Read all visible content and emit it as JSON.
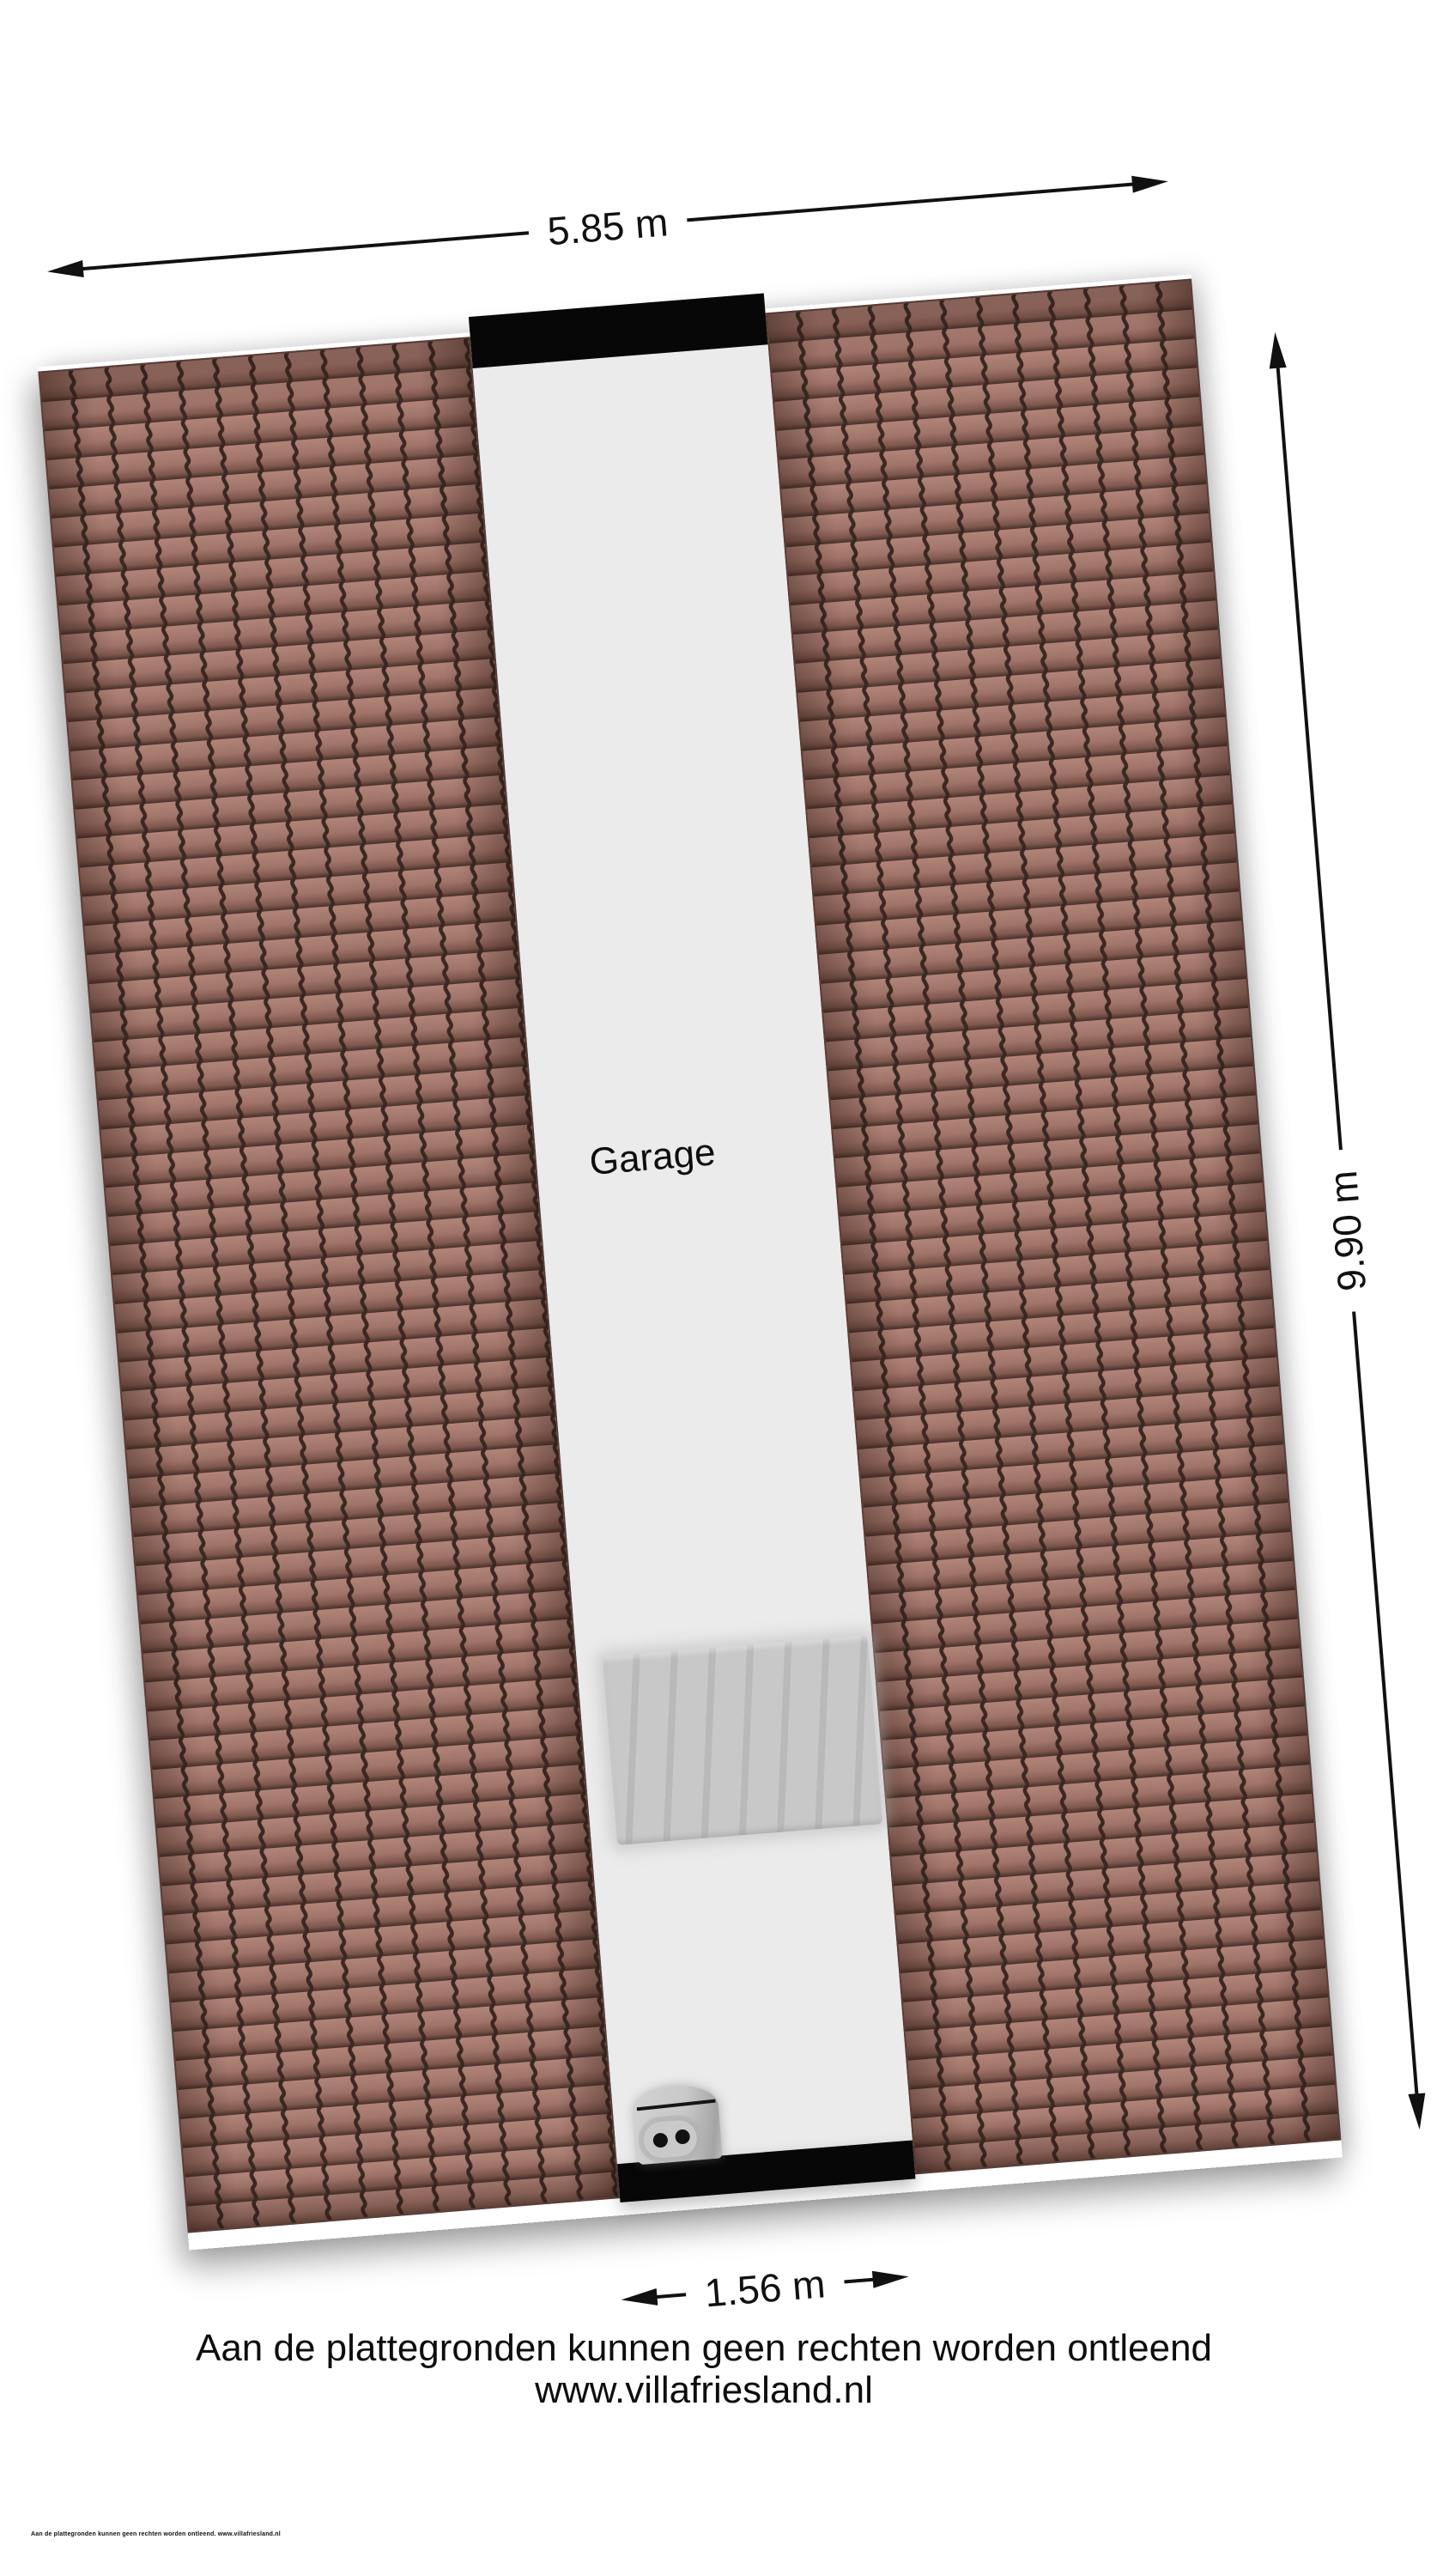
{
  "plan": {
    "room_label": "Garage",
    "dim_width": "5.85 m",
    "dim_height": "9.90 m",
    "dim_corridor": "1.56 m"
  },
  "footer": {
    "disclaimer_line1": "Aan de plattegronden kunnen geen rechten worden ontleend",
    "disclaimer_line2": "www.villafriesland.nl",
    "fineprint": "Aan de plattegronden kunnen geen rechten worden ontleend. www.villafriesland.nl"
  },
  "colors": {
    "roof_tile_light": "#b28478",
    "roof_tile": "#a1746a",
    "roof_tile_dark": "#7e574c",
    "roof_edge": "#46302a",
    "roof_groove": "#3a2822",
    "corridor": "#ebebeb",
    "wall_black": "#070707",
    "stairs": "#c8c8c8",
    "stairs_dark": "#b9b9b9",
    "boiler_plate": "#c9c9c9",
    "dimension": "#111111"
  }
}
